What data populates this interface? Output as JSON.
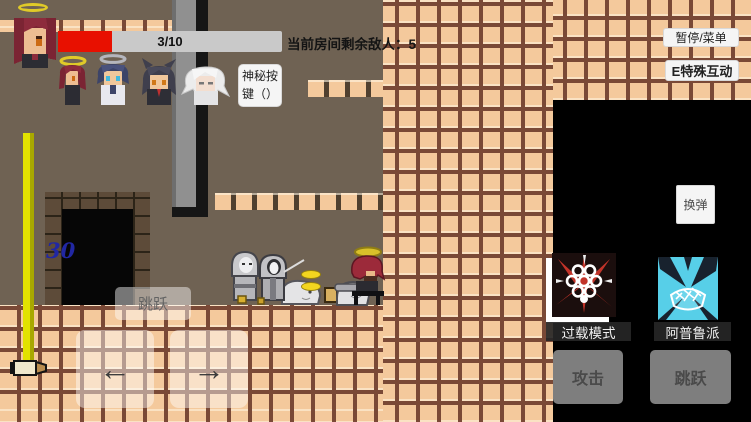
{
  "hud": {
    "health_bar": {
      "label": "3/10",
      "current": 3,
      "max": 10,
      "fill_percent": 24,
      "fill_color": "#e81000",
      "bg_color": "#c9c9c9"
    },
    "enemies_counter": "当前房间剩余敌人：5",
    "pause_menu_button": "暂停/菜单",
    "special_interact_button": "E特殊互动",
    "mystery_button_line1": "神秘按",
    "mystery_button_line2": "键（）",
    "reload_button": "换弹",
    "jump_hint_button": "跳跃",
    "attack_button": "攻击",
    "jump_button": "跳跃",
    "move_left_arrow": "←",
    "move_right_arrow": "→",
    "skills": [
      {
        "label": "过载模式",
        "icon": "overload-cluster-icon",
        "accent": "#c23329"
      },
      {
        "label": "阿普鲁派",
        "icon": "apple-pie-icon",
        "accent": "#57cfe8"
      }
    ]
  },
  "world": {
    "door_number": "30"
  },
  "party": {
    "leader_icon": "red-hair-halo-portrait",
    "members": [
      {
        "icon": "red-hair-halo-mini-portrait"
      },
      {
        "icon": "blue-hair-gray-halo-portrait"
      },
      {
        "icon": "black-hair-wolf-ears-portrait"
      },
      {
        "icon": "white-hair-portrait"
      }
    ]
  },
  "colors": {
    "tile": "#f4c99c",
    "grout": "#7a4936",
    "wall": "#6f6253",
    "pit": "#000000",
    "pole_yellow": "#e2e200",
    "halo_yellow": "#e0ca28",
    "coin_yellow": "#f3d51f",
    "door_number_blue": "#2127a3",
    "health_red": "#e81000"
  }
}
